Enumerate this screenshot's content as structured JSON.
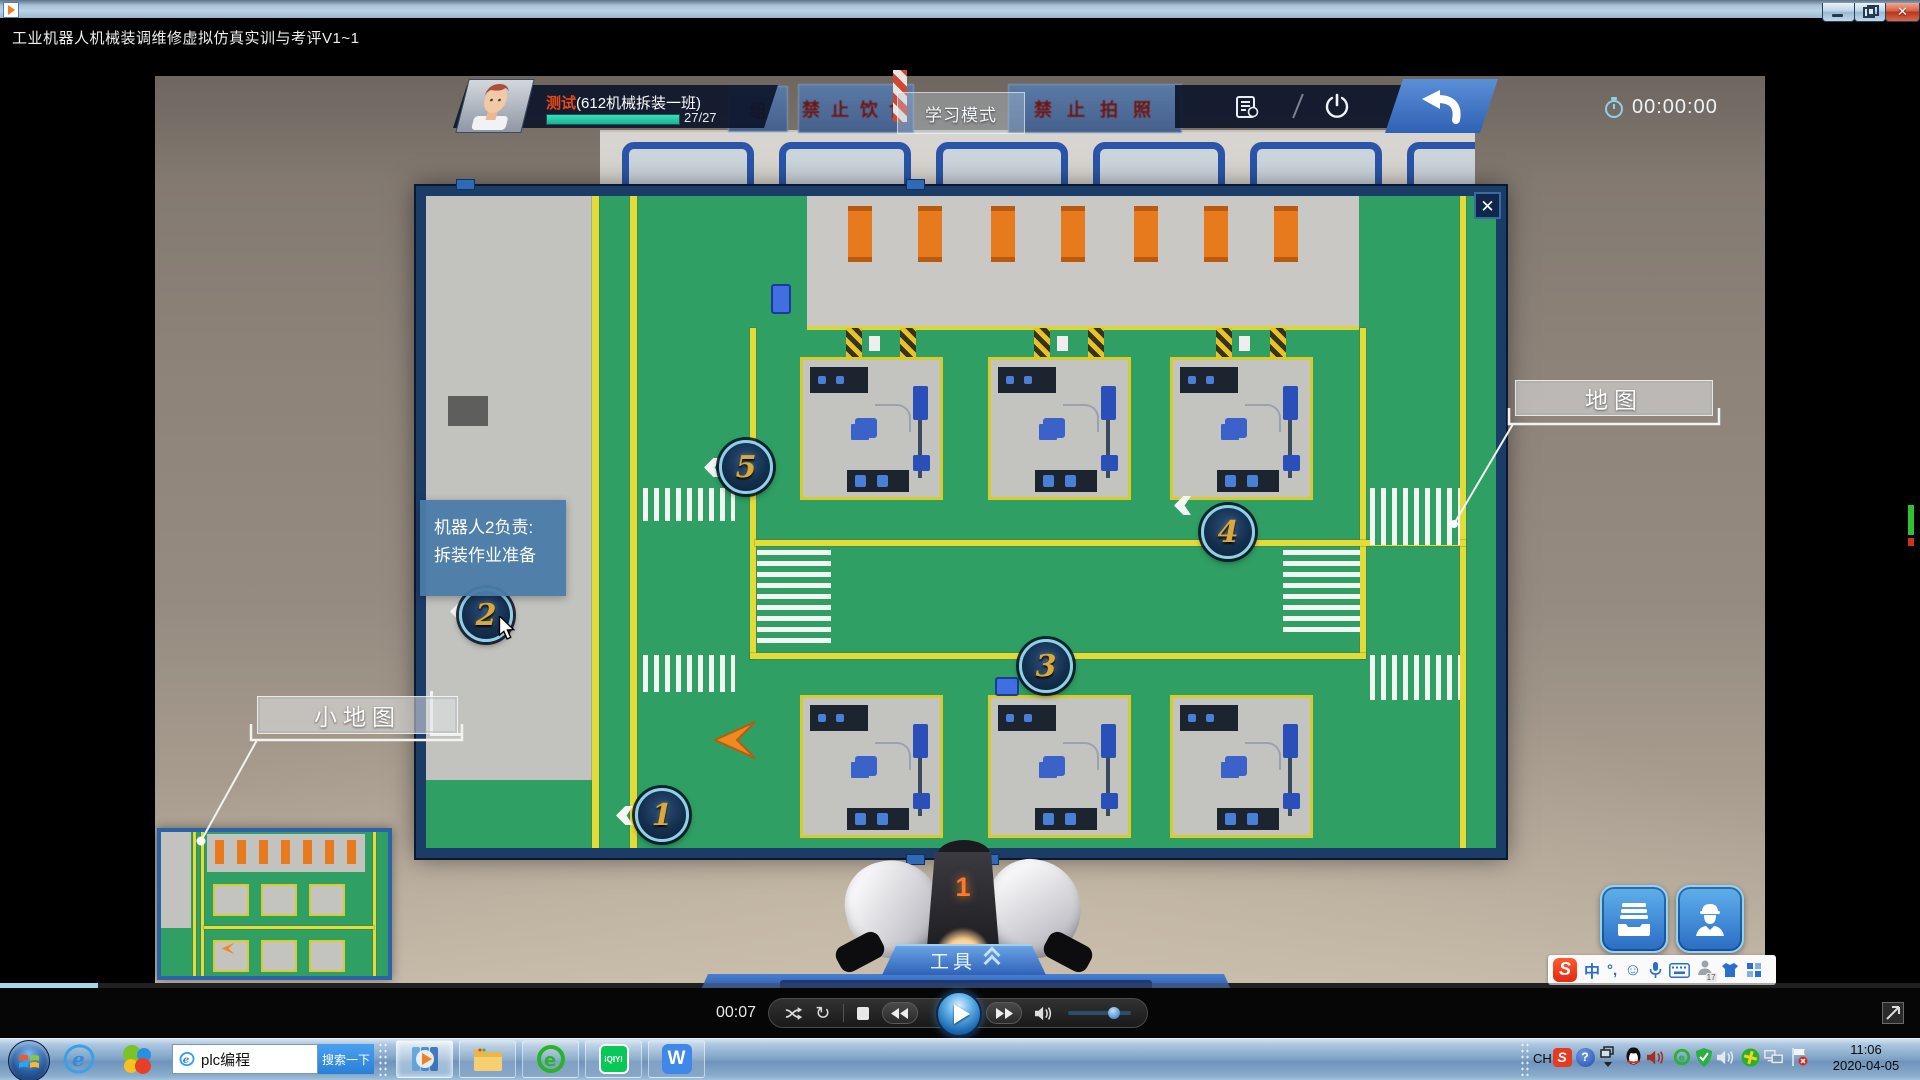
{
  "window": {
    "title": "工业机器人机械装调维修虚拟仿真实训与考评V1~1"
  },
  "sim": {
    "user_name": "测试",
    "class_info": "(612机械拆装一班)",
    "progress_text": "27/27",
    "mode_label": "学习模式",
    "timer": "00:00:00",
    "banner_partial": "组",
    "banner_no_food": "禁 止 饮 食",
    "banner_no_photo": "禁 止 拍 照"
  },
  "map_popup": {
    "close_glyph": "✕",
    "map_label": "地图",
    "minimap_label": "小地图",
    "tooltip": {
      "line1": "机器人2负责:",
      "line2": "拆装作业准备"
    },
    "markers": [
      {
        "label": "1",
        "x": 236,
        "y": 619
      },
      {
        "label": "2",
        "x": 60,
        "y": 419
      },
      {
        "label": "3",
        "x": 620,
        "y": 470
      },
      {
        "label": "4",
        "x": 802,
        "y": 336
      },
      {
        "label": "5",
        "x": 320,
        "y": 271
      }
    ]
  },
  "hud": {
    "tools_label": "工具",
    "button1_label": "资料",
    "button2_label": "人物装备",
    "robot_number": "1"
  },
  "player": {
    "elapsed": "00:07"
  },
  "sogou": {
    "logo": "S",
    "lang_glyph": "中",
    "punct_glyph": "°,",
    "smiley_glyph": "☺",
    "badge": "17"
  },
  "taskbar": {
    "search_value": "plc编程",
    "search_button": "搜索一下",
    "iqiyi_label": "iQIYI",
    "wps_label": "W",
    "tray_lang": "CH",
    "tray_help": "?",
    "clock_time": "11:06",
    "clock_date": "2020-04-05"
  }
}
